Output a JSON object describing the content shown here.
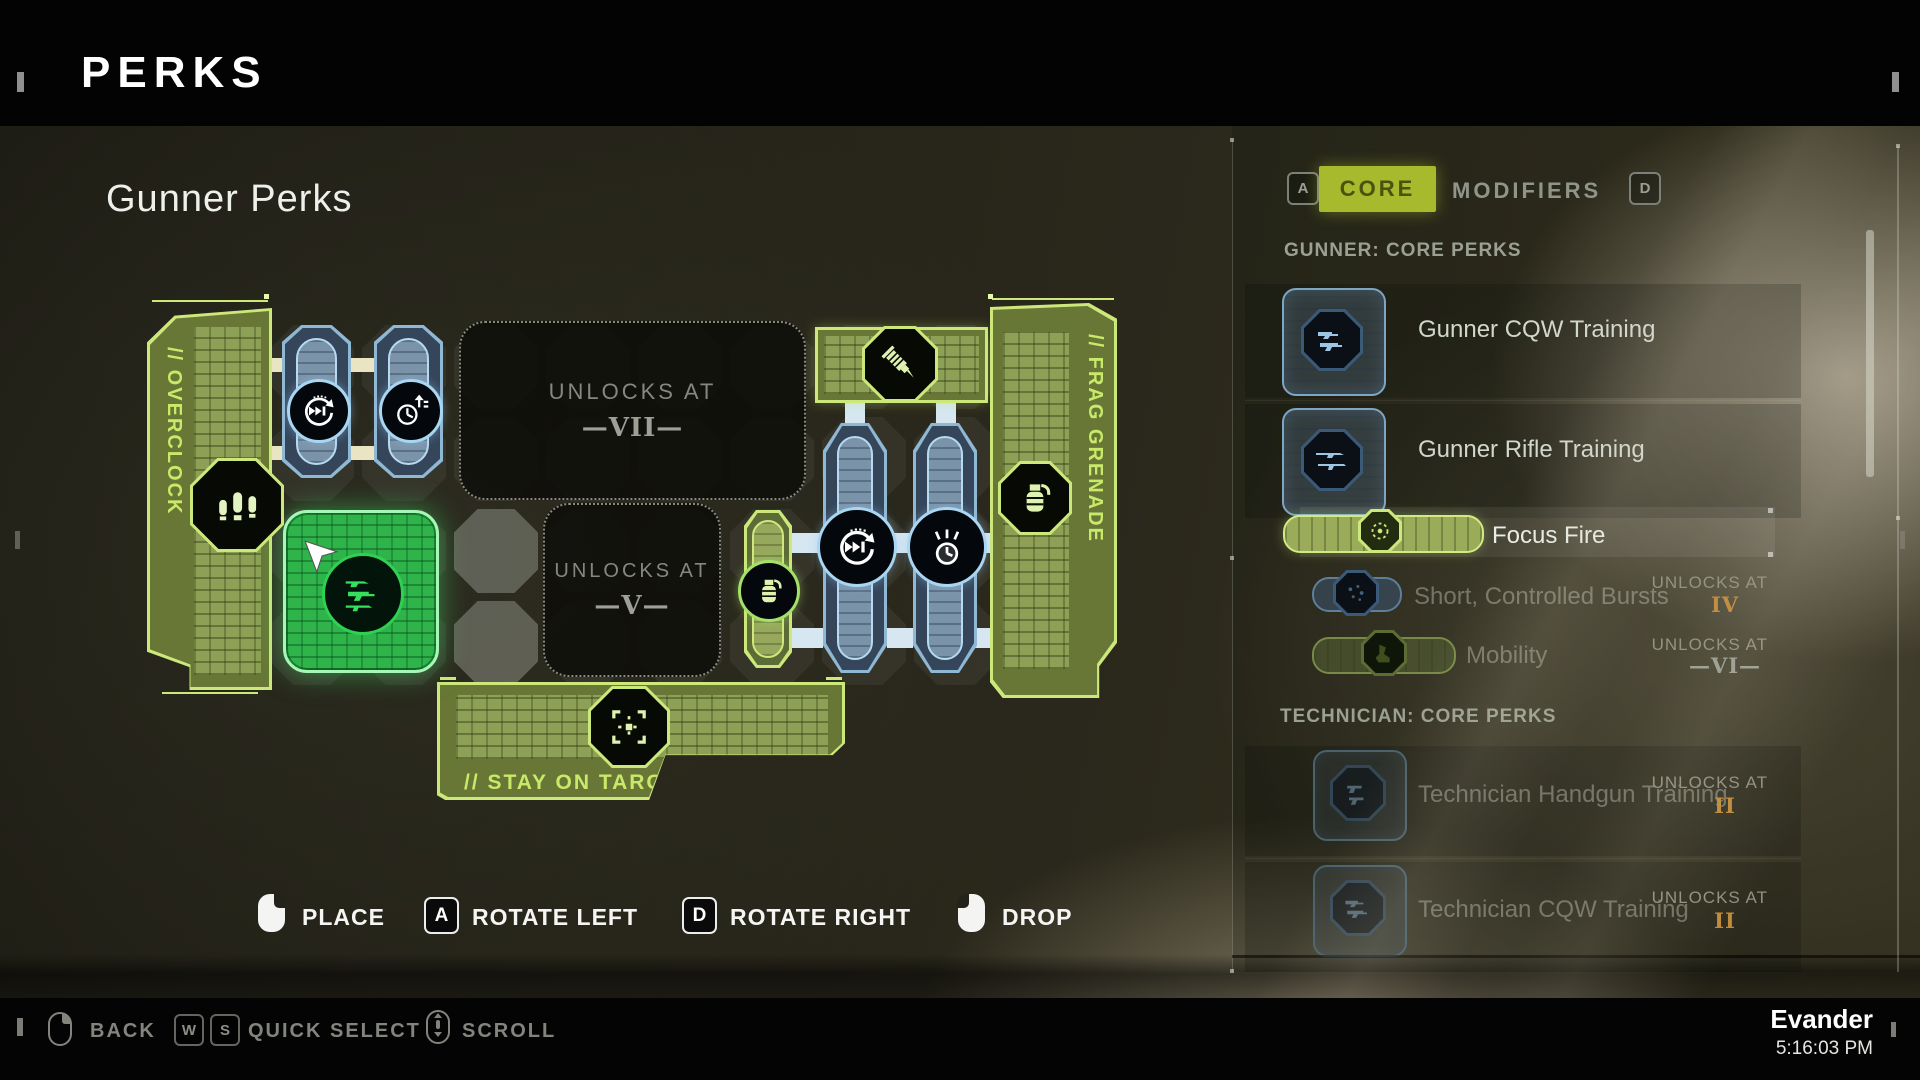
{
  "header": {
    "title": "PERKS"
  },
  "board": {
    "heading": "Gunner Perks",
    "overclock_label": "// OVERCLOCK",
    "frag_label": "// FRAG GRENADE",
    "stay_label": "// STAY ON TARGET",
    "locked_slot_7": {
      "label": "UNLOCKS AT",
      "value": "—VII—"
    },
    "locked_slot_5": {
      "label": "UNLOCKS AT",
      "value": "—V—"
    }
  },
  "controls": {
    "place_label": "PLACE",
    "rotate_left_key": "A",
    "rotate_left_label": "ROTATE LEFT",
    "rotate_right_key": "D",
    "rotate_right_label": "ROTATE RIGHT",
    "drop_label": "DROP"
  },
  "panel": {
    "tab_left_key": "A",
    "tab_core": "CORE",
    "tab_modifiers": "MODIFIERS",
    "tab_right_key": "D",
    "gunner_section_title": "GUNNER: CORE PERKS",
    "technician_section_title": "TECHNICIAN: CORE PERKS",
    "items": {
      "gunner_cqw": {
        "name": "Gunner CQW Training"
      },
      "gunner_rifle": {
        "name": "Gunner Rifle Training"
      },
      "focus_fire": {
        "name": "Focus Fire"
      },
      "short_controlled_bursts": {
        "name": "Short, Controlled Bursts",
        "unlock_label": "UNLOCKS AT",
        "unlock_value": "IV"
      },
      "mobility": {
        "name": "Mobility",
        "unlock_label": "UNLOCKS AT",
        "unlock_value": "—VI—"
      },
      "technician_handgun": {
        "name": "Technician Handgun Training",
        "unlock_label": "UNLOCKS AT",
        "unlock_value": "II"
      },
      "technician_cqw": {
        "name": "Technician CQW Training",
        "unlock_label": "UNLOCKS AT",
        "unlock_value": "II"
      }
    }
  },
  "footer": {
    "back_label": "BACK",
    "quick_key_1": "W",
    "quick_key_2": "S",
    "quick_select_label": "QUICK SELECT",
    "scroll_label": "SCROLL",
    "player_name": "Evander",
    "time": "5:16:03 PM"
  },
  "colors": {
    "accent_green": "#cde87a",
    "selected_green": "#2eb44a",
    "piece_blue": "#7b93a8",
    "tab_active_bg": "#a7ba2d",
    "gold_numeral": "#c28a3a"
  },
  "icons": [
    "bullets-icon",
    "reload-speed-icon",
    "cooldown-icon",
    "stim-dart-icon",
    "grenade-icon",
    "grenade-cook-icon",
    "crosshair-icon",
    "target-icon",
    "burst-icon",
    "boot-icon",
    "gun-icon",
    "mouse-left-icon",
    "mouse-right-icon",
    "mouse-scroll-icon",
    "cursor-icon"
  ]
}
